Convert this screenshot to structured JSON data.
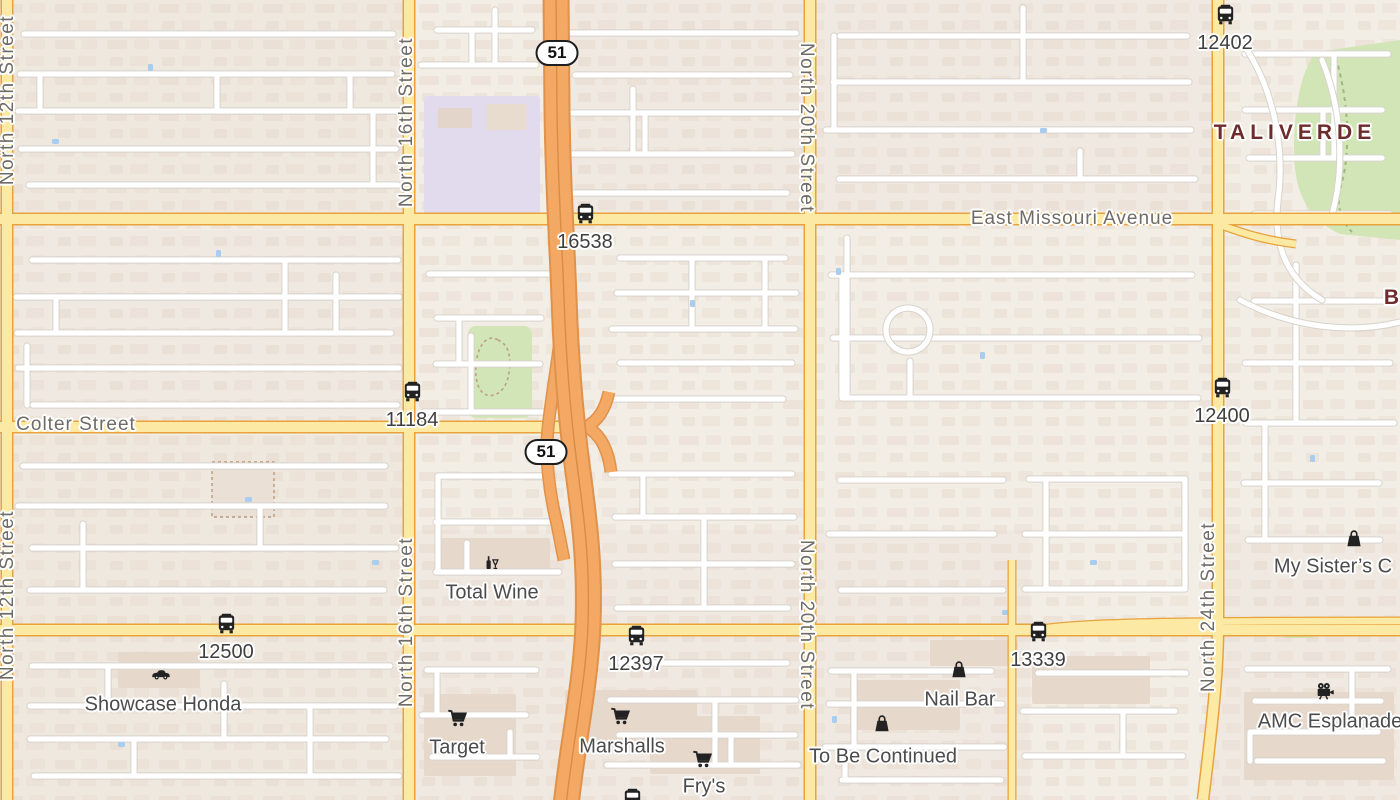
{
  "map": {
    "area_labels": [
      {
        "text": "TALIVERDE",
        "x": 1295,
        "y": 133
      },
      {
        "text": "B",
        "x": 1394,
        "y": 298
      }
    ],
    "street_labels_vertical": [
      {
        "text": "North 12th Street",
        "x": 8,
        "y": 100,
        "dir": "up"
      },
      {
        "text": "North 12th Street",
        "x": 8,
        "y": 595,
        "dir": "up"
      },
      {
        "text": "North 16th Street",
        "x": 407,
        "y": 122,
        "dir": "up"
      },
      {
        "text": "North 16th Street",
        "x": 407,
        "y": 622,
        "dir": "up"
      },
      {
        "text": "North 20th Street",
        "x": 806,
        "y": 128,
        "dir": "down"
      },
      {
        "text": "North 20th Street",
        "x": 806,
        "y": 625,
        "dir": "down"
      },
      {
        "text": "North 24th Street",
        "x": 1209,
        "y": 607,
        "dir": "up"
      }
    ],
    "street_labels_horizontal": [
      {
        "text": "East Missouri Avenue",
        "x": 1072,
        "y": 219
      },
      {
        "text": "Colter Street",
        "x": 76,
        "y": 425
      }
    ],
    "highway_shields": [
      {
        "label": "51",
        "x": 557,
        "y": 53
      },
      {
        "label": "51",
        "x": 546,
        "y": 452
      }
    ],
    "bus_stops": [
      {
        "id": "12402",
        "x": 1225,
        "y": 15
      },
      {
        "id": "16538",
        "x": 585,
        "y": 214
      },
      {
        "id": "11184",
        "x": 412,
        "y": 392
      },
      {
        "id": "12400",
        "x": 1222,
        "y": 388
      },
      {
        "id": "12500",
        "x": 226,
        "y": 624
      },
      {
        "id": "12397",
        "x": 636,
        "y": 636
      },
      {
        "id": "13339",
        "x": 1038,
        "y": 632
      },
      {
        "id": "",
        "x": 632,
        "y": 799
      }
    ],
    "pois": [
      {
        "name": "Total Wine",
        "icon": "wine",
        "x": 492,
        "y": 593,
        "ix": 490,
        "iy": 564
      },
      {
        "name": "Showcase Honda",
        "icon": "car",
        "x": 163,
        "y": 705,
        "ix": 161,
        "iy": 673
      },
      {
        "name": "Target",
        "icon": "cart",
        "x": 457,
        "y": 748,
        "ix": 457,
        "iy": 718
      },
      {
        "name": "Marshalls",
        "icon": "cart",
        "x": 622,
        "y": 747,
        "ix": 620,
        "iy": 716
      },
      {
        "name": "Fry's",
        "icon": "cart",
        "x": 704,
        "y": 787,
        "ix": 702,
        "iy": 759
      },
      {
        "name": "Nail Bar",
        "icon": "bag",
        "x": 960,
        "y": 700,
        "ix": 959,
        "iy": 669
      },
      {
        "name": "To Be Continued",
        "icon": "bag",
        "x": 883,
        "y": 757,
        "ix": 882,
        "iy": 723
      },
      {
        "name": "My Sister’s C",
        "icon": "bag",
        "x": 1333,
        "y": 567,
        "ix": 1354,
        "iy": 538
      },
      {
        "name": "AMC Esplanade",
        "icon": "cine",
        "x": 1330,
        "y": 722,
        "ix": 1325,
        "iy": 691
      }
    ],
    "colors": {
      "background": "#f2eee6",
      "residential_tint": "#ecdfd6",
      "building": "#e7d9ce",
      "road_minor_casing": "#d8d3cb",
      "road_major_fill": "#fce9a4",
      "road_major_casing": "#e8a33c",
      "highway_fill": "#f3a964",
      "highway_casing": "#e0914a",
      "park_green": "#d2e5b6",
      "school_purple": "#e2dbee",
      "water_blue": "#a8cdf0",
      "street_label": "#6f6b66",
      "poi_label": "#4c4c4c",
      "bus_label": "#3f3f3f",
      "area_label": "#6d2b2b"
    }
  }
}
